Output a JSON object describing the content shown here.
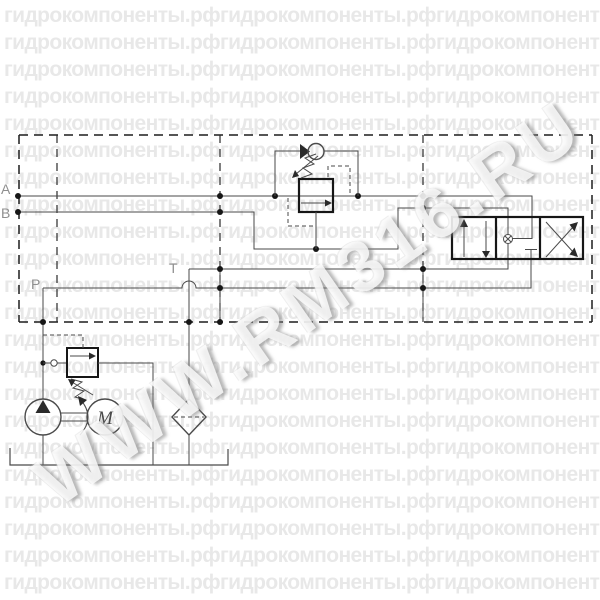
{
  "diagram": {
    "port_labels": {
      "a": "A",
      "b": "B",
      "p": "P",
      "t": "T"
    },
    "motor_label": "M",
    "components": [
      "manifold-enclosure",
      "check-valve",
      "pressure-reducing-valve",
      "directional-control-valve",
      "relief-valve",
      "pump",
      "electric-motor",
      "filter",
      "tank"
    ]
  },
  "watermark": {
    "tile_text": "гидрокомпоненты.рф",
    "row_text": "гидрокомпоненты.рфгидрокомпоненты.рфгидрокомпоненты.рфгидрокомпоненты.рф",
    "rows": 22,
    "diagonal_text": "WWW.RM316.RU"
  },
  "colors": {
    "line": "#4a4a4a",
    "bold_line": "#161616",
    "label": "#8f8f8f",
    "watermark_tile": "#e8e8e8",
    "background": "#ffffff"
  }
}
